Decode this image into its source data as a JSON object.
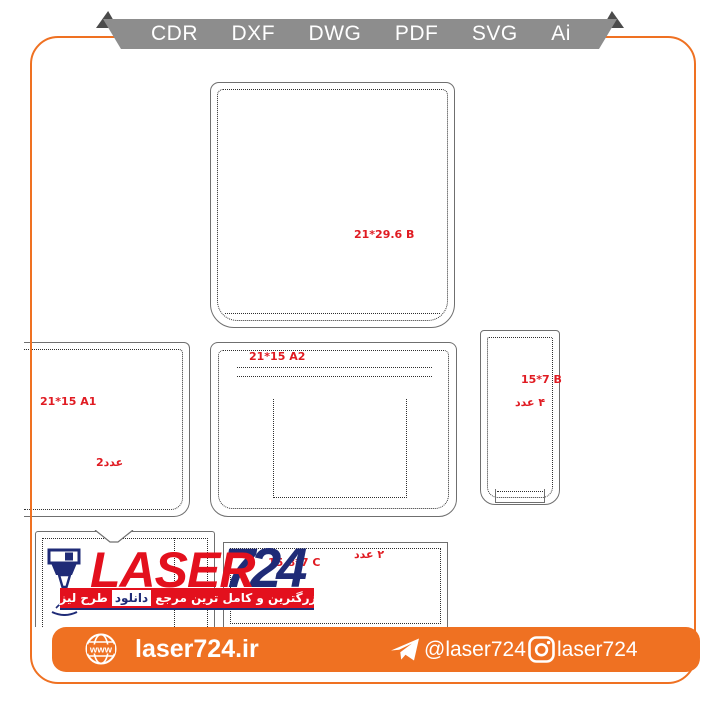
{
  "ribbon": {
    "formats": [
      "CDR",
      "DXF",
      "DWG",
      "PDF",
      "SVG",
      "Ai"
    ]
  },
  "pieces": {
    "top": {
      "label": "21*29.6 B"
    },
    "mid_left": {
      "label": "21*15 A1",
      "qty": "2عدد"
    },
    "mid_center": {
      "label": "21*15 A2"
    },
    "mid_right": {
      "label": "15*7 B",
      "qty": "۴ عدد"
    },
    "bottom_right": {
      "label": "15.8*7 C",
      "qty": "۲ عدد"
    }
  },
  "logo": {
    "word": "LASER",
    "number": "724",
    "tagline_start": "بزرگترین و کامل ترین مرجع",
    "tagline_highlight": "دانلود",
    "tagline_end": "طرح لیزر"
  },
  "footer": {
    "globe_text": "www",
    "website": "laser724.ir",
    "telegram": "@laser724",
    "instagram": "laser724"
  },
  "colors": {
    "accent_orange": "#ef7122",
    "ribbon_gray": "#8d8d8d",
    "fold_gray": "#4b4b4b",
    "label_red": "#e01b22",
    "brand_red": "#e3101d",
    "brand_navy": "#1f2b77",
    "outline_gray": "#6f6f6f"
  }
}
